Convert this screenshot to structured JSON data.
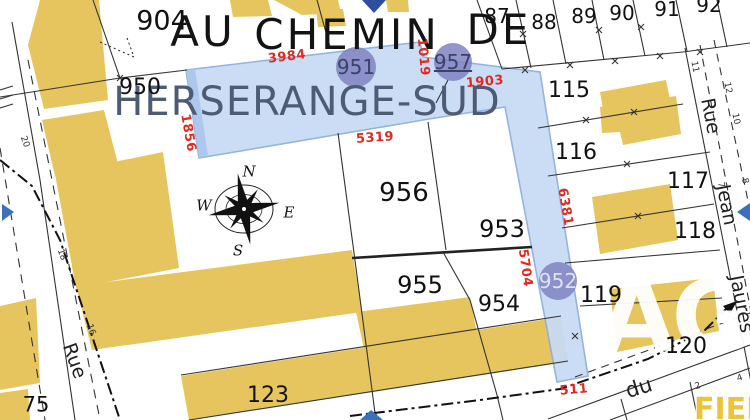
{
  "map_title": "Cadastral plan — Herserange-Sud",
  "colors": {
    "background": "#ffffff",
    "building": "#e7c55e",
    "highlight_fill": "#c7dbf5",
    "highlight_edge": "#8aaede",
    "highlight_edge_dark": "#a9c6ec",
    "circle": "#7d7fc0",
    "red": "#e02a20",
    "slate_text": "#4d5b75",
    "arrow_blue": "#3b6fc0",
    "marker_blue": "#2e4f9e"
  },
  "watermark": {
    "agency_mark": "AG",
    "corner_mark": "FIERR"
  },
  "map_labels": [
    {
      "n": "place-name-au",
      "t": "AU",
      "x": 203,
      "y": 32,
      "fs": 42,
      "cls": "big"
    },
    {
      "n": "place-name-chemin",
      "t": "CHEMIN",
      "x": 347,
      "y": 35,
      "fs": 42,
      "cls": "big"
    },
    {
      "n": "place-name-de",
      "t": "DE",
      "x": 499,
      "y": 30,
      "fs": 42,
      "cls": "big"
    },
    {
      "n": "place-name-herserange-sud",
      "t": "HERSERANGE-SUD",
      "x": 307,
      "y": 102,
      "fs": 40,
      "cls": "big slate"
    },
    {
      "n": "parcel-904",
      "t": "904",
      "x": 162,
      "y": 21,
      "fs": 27,
      "cls": "parcel"
    },
    {
      "n": "parcel-950",
      "t": "950",
      "x": 140,
      "y": 88,
      "fs": 22,
      "cls": "parcel"
    },
    {
      "n": "parcel-87",
      "t": "87",
      "x": 497,
      "y": 16,
      "fs": 20,
      "cls": "parcel"
    },
    {
      "n": "parcel-88",
      "t": "88",
      "x": 544,
      "y": 22,
      "fs": 20,
      "cls": "parcel"
    },
    {
      "n": "parcel-89",
      "t": "89",
      "x": 584,
      "y": 16,
      "fs": 20,
      "cls": "parcel"
    },
    {
      "n": "parcel-90",
      "t": "90",
      "x": 622,
      "y": 13,
      "fs": 20,
      "cls": "parcel"
    },
    {
      "n": "parcel-91",
      "t": "91",
      "x": 667,
      "y": 9,
      "fs": 20,
      "cls": "parcel"
    },
    {
      "n": "parcel-92",
      "t": "92",
      "x": 709,
      "y": 5,
      "fs": 20,
      "cls": "parcel"
    },
    {
      "n": "parcel-115",
      "t": "115",
      "x": 569,
      "y": 91,
      "fs": 22,
      "cls": "parcel"
    },
    {
      "n": "parcel-116",
      "t": "116",
      "x": 576,
      "y": 153,
      "fs": 22,
      "cls": "parcel"
    },
    {
      "n": "parcel-117",
      "t": "117",
      "x": 688,
      "y": 182,
      "fs": 22,
      "cls": "parcel"
    },
    {
      "n": "parcel-118",
      "t": "118",
      "x": 695,
      "y": 232,
      "fs": 22,
      "cls": "parcel"
    },
    {
      "n": "parcel-119",
      "t": "119",
      "x": 601,
      "y": 296,
      "fs": 22,
      "cls": "parcel"
    },
    {
      "n": "parcel-120",
      "t": "120",
      "x": 686,
      "y": 347,
      "fs": 22,
      "cls": "parcel"
    },
    {
      "n": "parcel-956",
      "t": "956",
      "x": 404,
      "y": 193,
      "fs": 26,
      "cls": "parcel"
    },
    {
      "n": "parcel-953",
      "t": "953",
      "x": 502,
      "y": 229,
      "fs": 24,
      "cls": "parcel"
    },
    {
      "n": "parcel-955",
      "t": "955",
      "x": 420,
      "y": 285,
      "fs": 24,
      "cls": "parcel"
    },
    {
      "n": "parcel-954",
      "t": "954",
      "x": 499,
      "y": 305,
      "fs": 22,
      "cls": "parcel"
    },
    {
      "n": "parcel-123",
      "t": "123",
      "x": 268,
      "y": 396,
      "fs": 22,
      "cls": "parcel"
    },
    {
      "n": "parcel-75",
      "t": "75",
      "x": 36,
      "y": 405,
      "fs": 21,
      "cls": "parcel"
    },
    {
      "n": "parcel-circle-label-951",
      "t": "951",
      "x": 356,
      "y": 67,
      "fs": 20,
      "cls": "circle-label"
    },
    {
      "n": "parcel-circle-label-957",
      "t": "957",
      "x": 453,
      "y": 62,
      "fs": 20,
      "cls": "circle-label u"
    },
    {
      "n": "parcel-circle-label-952",
      "t": "952",
      "x": 558,
      "y": 281,
      "fs": 20,
      "cls": "circle-label light"
    },
    {
      "n": "measure-3984",
      "t": "3984",
      "x": 287,
      "y": 57,
      "fs": 13,
      "r": -7,
      "cls": "red"
    },
    {
      "n": "measure-1019",
      "t": "1019",
      "x": 423,
      "y": 57,
      "fs": 13,
      "r": 85,
      "cls": "red"
    },
    {
      "n": "measure-1903",
      "t": "1903",
      "x": 485,
      "y": 82,
      "fs": 13,
      "r": -5,
      "cls": "red"
    },
    {
      "n": "measure-1856",
      "t": "1856",
      "x": 188,
      "y": 133,
      "fs": 13,
      "r": 80,
      "cls": "red"
    },
    {
      "n": "measure-5319",
      "t": "5319",
      "x": 375,
      "y": 138,
      "fs": 13,
      "r": -4,
      "cls": "red"
    },
    {
      "n": "measure-6381",
      "t": "6381",
      "x": 565,
      "y": 207,
      "fs": 13,
      "r": 80,
      "cls": "red"
    },
    {
      "n": "measure-5704",
      "t": "5704",
      "x": 525,
      "y": 268,
      "fs": 13,
      "r": 82,
      "cls": "red"
    },
    {
      "n": "measure-511",
      "t": "511",
      "x": 574,
      "y": 390,
      "fs": 13,
      "r": -5,
      "cls": "red"
    },
    {
      "n": "street-rue-left",
      "t": "Rue",
      "x": 74,
      "y": 361,
      "fs": 19,
      "r": 70,
      "cls": "street"
    },
    {
      "n": "street-rue-right",
      "t": "Rue",
      "x": 710,
      "y": 116,
      "fs": 19,
      "r": 79,
      "cls": "street"
    },
    {
      "n": "street-jean",
      "t": "Jean",
      "x": 726,
      "y": 205,
      "fs": 19,
      "r": 79,
      "cls": "street"
    },
    {
      "n": "street-jaures",
      "t": "Jaurès",
      "x": 741,
      "y": 304,
      "fs": 19,
      "r": 79,
      "cls": "street"
    },
    {
      "n": "street-du",
      "t": "du",
      "x": 639,
      "y": 388,
      "fs": 21,
      "r": -17,
      "cls": "street"
    },
    {
      "n": "house-number-20",
      "t": "20",
      "x": 24,
      "y": 142,
      "fs": 9,
      "r": 70,
      "cls": "hn"
    },
    {
      "n": "house-number-18",
      "t": "18",
      "x": 61,
      "y": 255,
      "fs": 9,
      "r": 70,
      "cls": "hn"
    },
    {
      "n": "house-number-16",
      "t": "16",
      "x": 90,
      "y": 330,
      "fs": 9,
      "r": 70,
      "cls": "hn"
    },
    {
      "n": "house-number-11",
      "t": "11",
      "x": 694,
      "y": 67,
      "fs": 9,
      "r": 79,
      "cls": "hn"
    },
    {
      "n": "house-number-12",
      "t": "12",
      "x": 727,
      "y": 88,
      "fs": 9,
      "r": 79,
      "cls": "hn"
    },
    {
      "n": "house-number-10",
      "t": "10",
      "x": 735,
      "y": 119,
      "fs": 9,
      "r": 79,
      "cls": "hn"
    },
    {
      "n": "house-number-8",
      "t": "8",
      "x": 744,
      "y": 181,
      "fs": 9,
      "r": 79,
      "cls": "hn"
    },
    {
      "n": "house-number-7",
      "t": "7",
      "x": 720,
      "y": 185,
      "fs": 9,
      "r": 79,
      "cls": "hn"
    },
    {
      "n": "house-number-2",
      "t": "2",
      "x": 698,
      "y": 387,
      "fs": 9,
      "r": -17,
      "cls": "hn"
    },
    {
      "n": "house-number-4",
      "t": "4",
      "x": 740,
      "y": 379,
      "fs": 9,
      "r": -17,
      "cls": "hn"
    },
    {
      "n": "compass-letter-n",
      "t": "N",
      "x": 249,
      "y": 172,
      "fs": 15,
      "cls": "cl"
    },
    {
      "n": "compass-letter-e",
      "t": "E",
      "x": 289,
      "y": 213,
      "fs": 15,
      "cls": "cl"
    },
    {
      "n": "compass-letter-s",
      "t": "S",
      "x": 238,
      "y": 251,
      "fs": 15,
      "cls": "cl"
    },
    {
      "n": "compass-letter-w",
      "t": "W",
      "x": 204,
      "y": 206,
      "fs": 15,
      "cls": "cl"
    }
  ]
}
